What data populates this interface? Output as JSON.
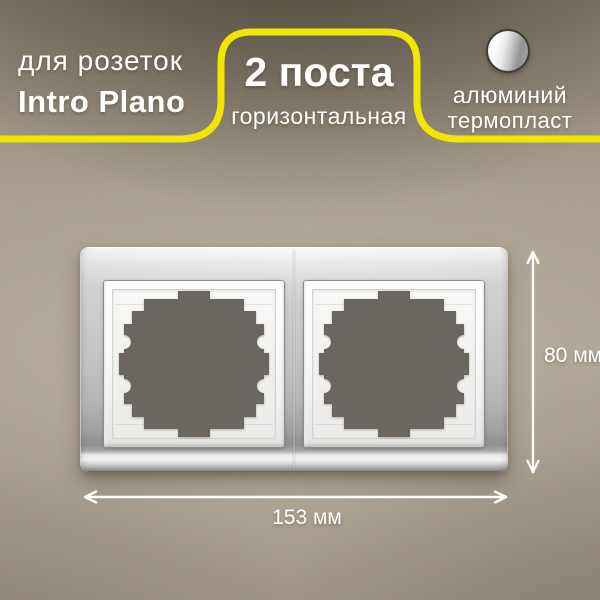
{
  "badges": {
    "product": {
      "line1": "для розеток",
      "line2": "Intro Plano"
    },
    "config": {
      "line1": "2 поста",
      "line2": "горизонтальная"
    },
    "material": {
      "line1": "алюминий",
      "line2": "термопласт",
      "icon": "aluminum-material-icon"
    }
  },
  "dimensions": {
    "height": "80 мм",
    "width": "153 мм"
  },
  "product": {
    "openings": "2"
  },
  "colors": {
    "accent": "#f2e600",
    "wall": "#b2a99a",
    "aperture": "#6c6661",
    "text": "#ffffff"
  }
}
